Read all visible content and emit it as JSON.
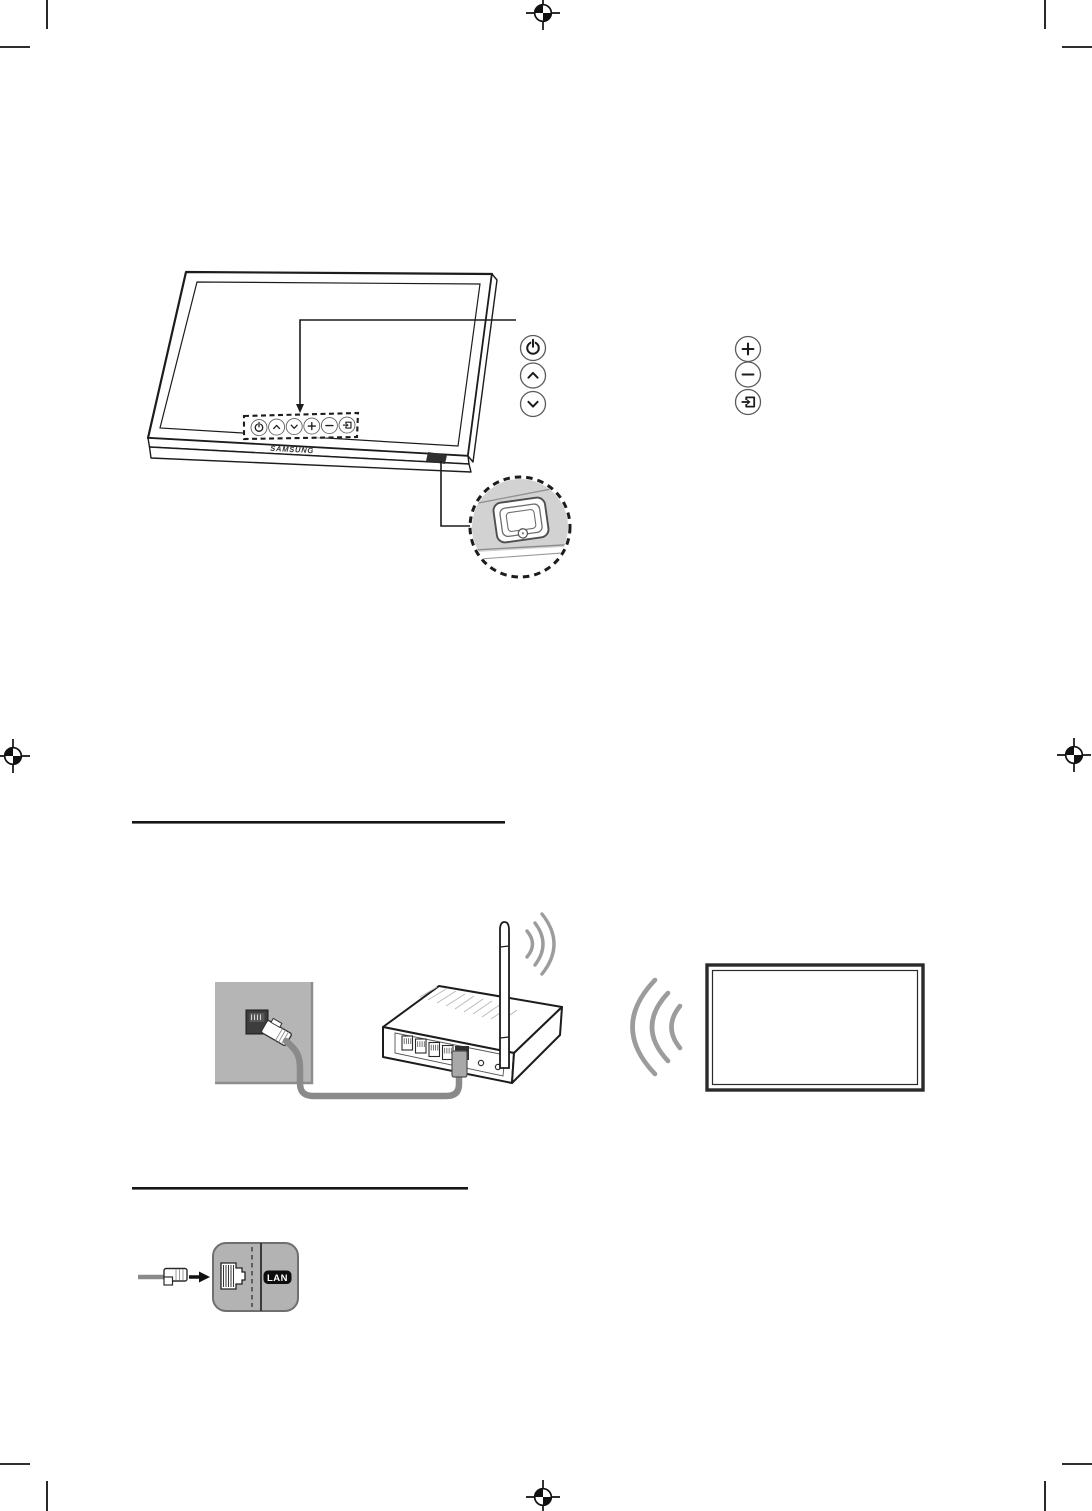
{
  "page": {
    "width": 1092,
    "height": 1511,
    "background": "#ffffff",
    "kind": "tv-user-manual-page"
  },
  "labels": {
    "brand_logo": "SAMSUNG",
    "lan_port": "LAN"
  },
  "tv_controller_panel": {
    "buttons": [
      "power",
      "channel-up",
      "channel-down",
      "volume-up",
      "volume-down",
      "source"
    ],
    "detail_callout": "controller-jog-button"
  },
  "button_legend": {
    "left_column_icons": [
      "power-icon",
      "chevron-up-icon",
      "chevron-down-icon"
    ],
    "right_column_icons": [
      "plus-icon",
      "minus-icon",
      "source-icon"
    ]
  },
  "section_rules": [
    {
      "y": 822,
      "x1": 132,
      "x2": 505
    },
    {
      "y": 1188,
      "x1": 132,
      "x2": 468
    }
  ],
  "diagrams": {
    "wireless_network": [
      "wall-ethernet-outlet",
      "ethernet-cable",
      "wireless-router-with-antenna",
      "wifi-signal-arcs",
      "tv-screen"
    ],
    "wired_lan": [
      "ethernet-cable-plug",
      "arrow-right-icon",
      "lan-wall-port",
      "lan-badge"
    ]
  },
  "print_marks": {
    "registration_positions": [
      {
        "x": 543,
        "y": 13
      },
      {
        "x": 13,
        "y": 756
      },
      {
        "x": 1074,
        "y": 755
      },
      {
        "x": 543,
        "y": 1497
      }
    ],
    "corner_crop_marks": true
  },
  "colors": {
    "page_background": "#ffffff",
    "line_art": "#1c1c1c",
    "wall_gray": "#b5b5b5",
    "cable_gray": "#8a8a8a",
    "signal_arc_gray": "#9c9c9c",
    "detail_circle_fill": "#d2d2d2",
    "lan_box_gray": "#b3b3b3",
    "badge_black": "#0d0d0d",
    "badge_text": "#ffffff"
  }
}
